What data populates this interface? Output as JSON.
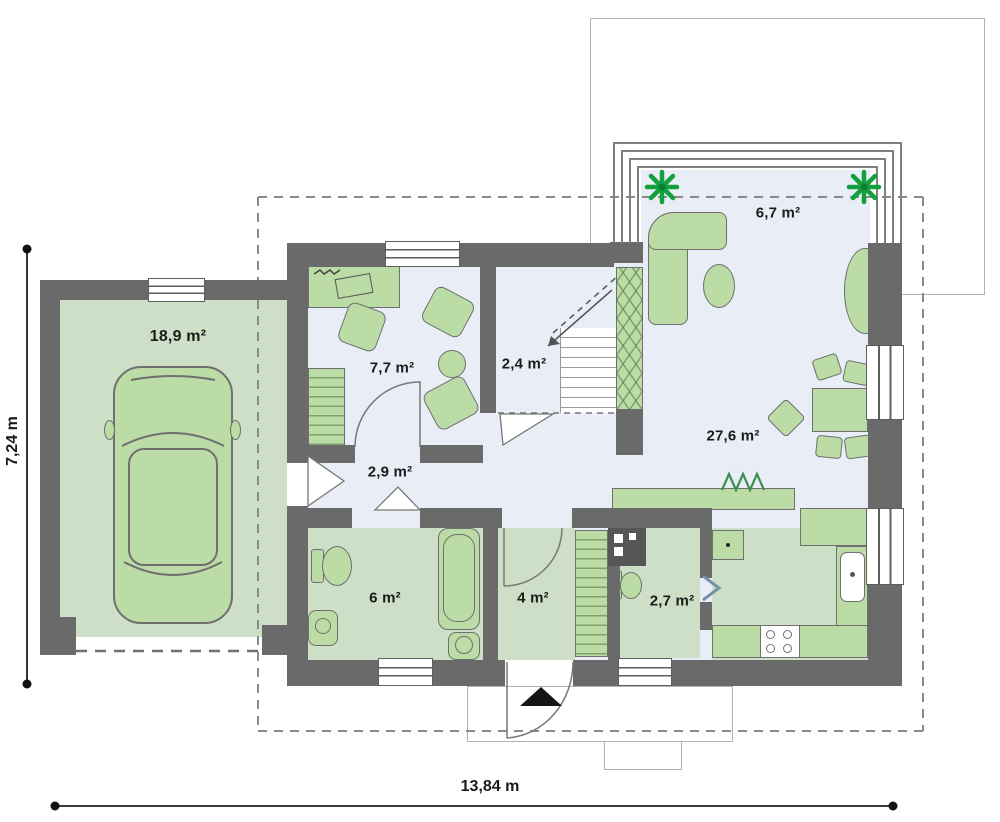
{
  "plan": {
    "type": "house-ground-floor-plan",
    "rooms": [
      {
        "id": "garage",
        "label": "18,9 m²"
      },
      {
        "id": "office",
        "label": "7,7 m²"
      },
      {
        "id": "stair-hall",
        "label": "2,4 m²"
      },
      {
        "id": "terrace",
        "label": "6,7 m²"
      },
      {
        "id": "living-room",
        "label": "27,6 m²"
      },
      {
        "id": "hallway",
        "label": "2,9 m²"
      },
      {
        "id": "bathroom",
        "label": "6 m²"
      },
      {
        "id": "entry",
        "label": "4 m²"
      },
      {
        "id": "wc",
        "label": "2,7 m²"
      }
    ],
    "dimensions": {
      "width_label": "13,84 m",
      "depth_label": "7,24 m"
    },
    "colors": {
      "wall": "#6a6a6a",
      "floor": "#e9edf6",
      "gfloor": "#cddfc6",
      "furn": "#bcdca6",
      "furnb": "#6f6f6f",
      "tree": "#13a03f",
      "frame": "#7f7f7f",
      "label": "#1b1b1b",
      "dash": "#8a8a8a",
      "dim": "#1f1f1f"
    }
  }
}
